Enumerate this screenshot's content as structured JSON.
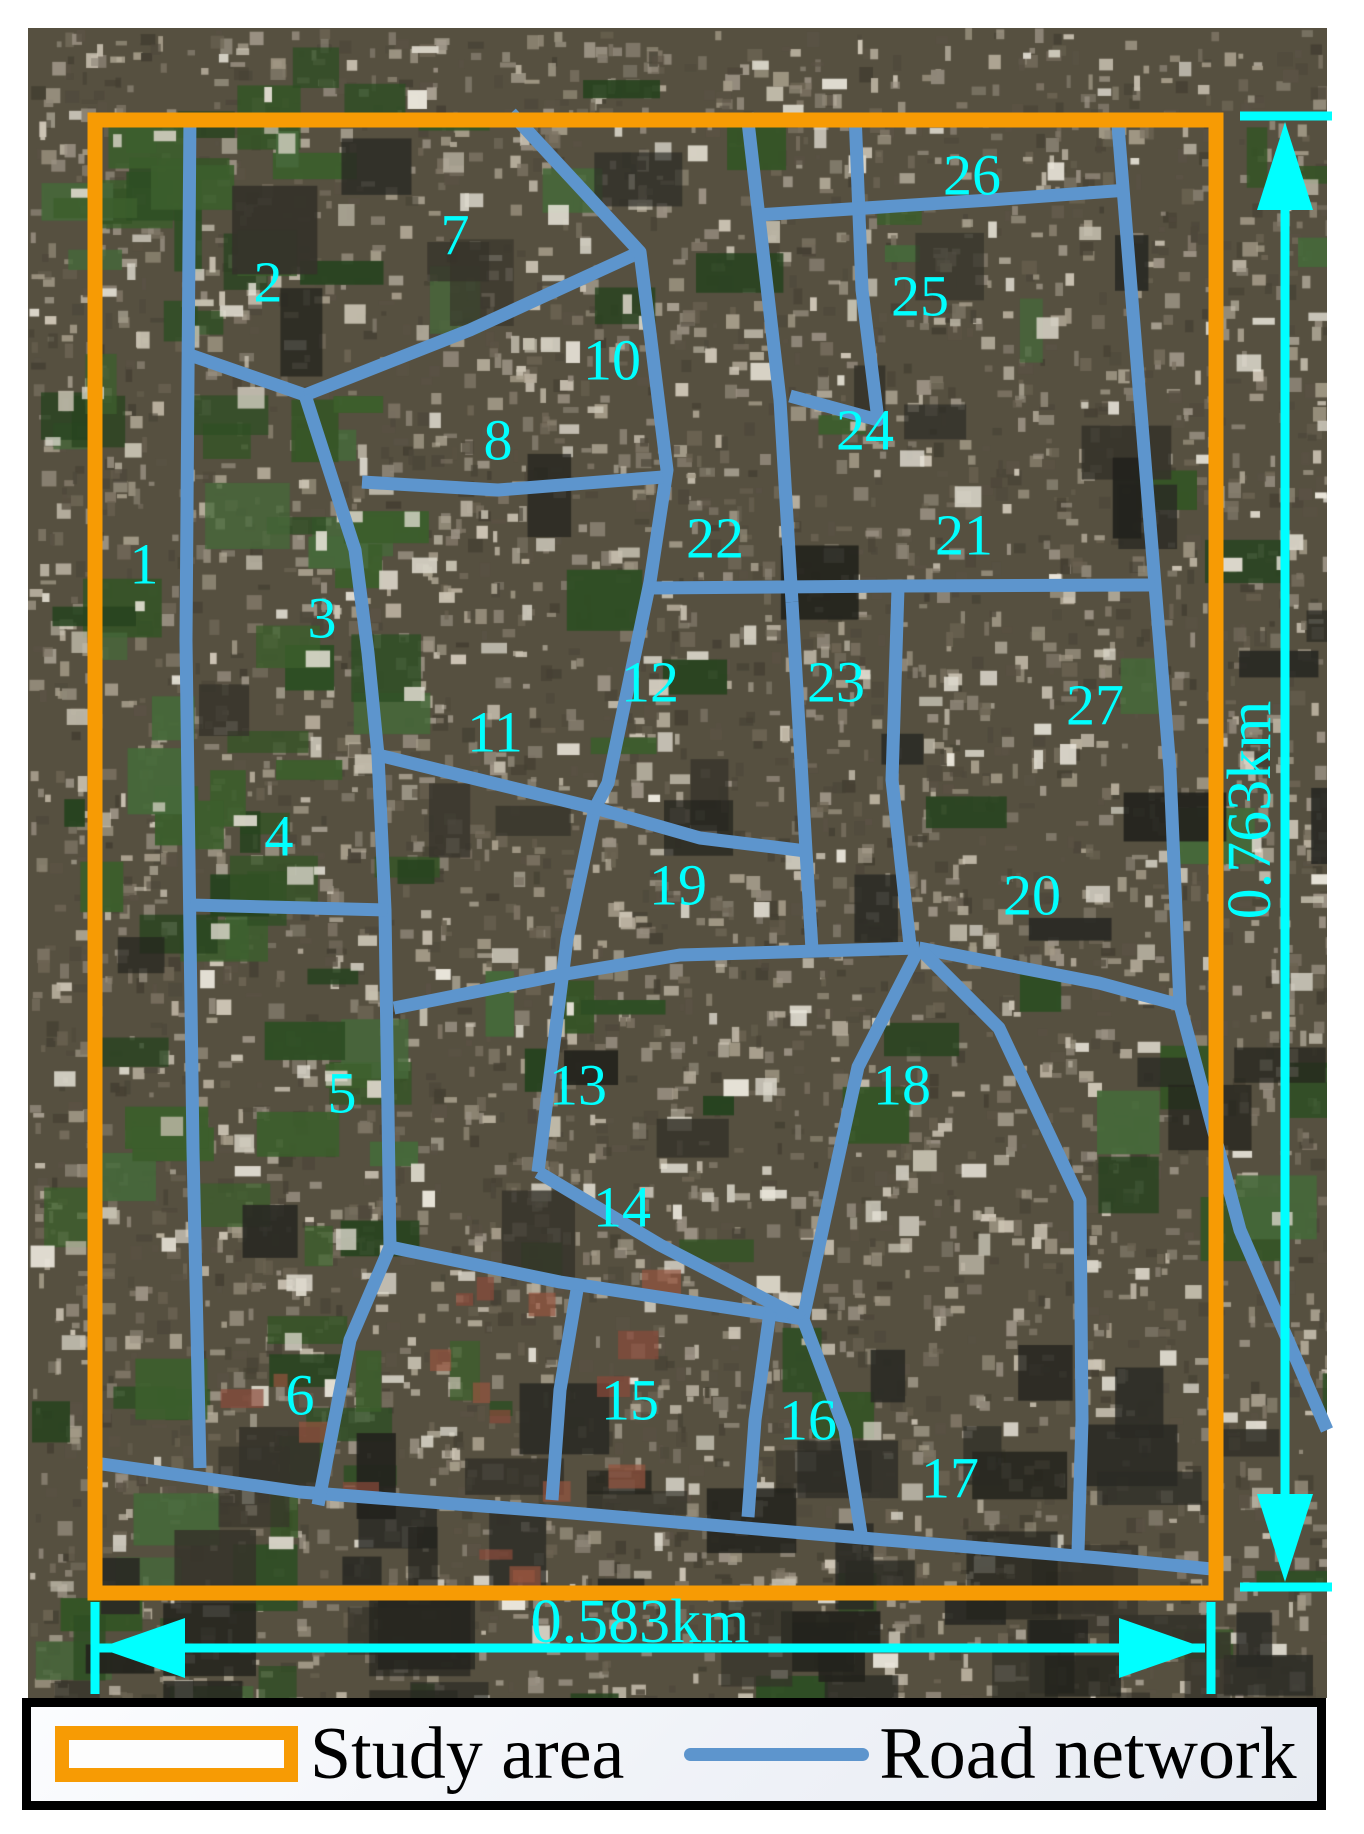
{
  "figure_type": "study-area-satellite-map",
  "colors": {
    "study_area": "#F79B04",
    "road": "#5D95CD",
    "annotation": "#00FFFF",
    "legend_text": "#000000",
    "legend_bg": "#f2f4f9"
  },
  "legend": {
    "items": [
      {
        "label": "Study area",
        "swatch": "orange-rect-icon"
      },
      {
        "label": "Road network",
        "swatch": "blue-line-icon"
      }
    ]
  },
  "dimensions": {
    "vertical": {
      "label": "0.763km",
      "label_pos": [
        1248,
        810
      ],
      "line": [
        1285,
        205,
        1285,
        1500
      ],
      "ticks": [
        [
          1240,
          116,
          1332,
          116
        ],
        [
          1240,
          1587,
          1332,
          1587
        ]
      ],
      "arrows": [
        [
          1285,
          122,
          1257,
          210,
          1313,
          210
        ],
        [
          1285,
          1582,
          1257,
          1494,
          1313,
          1494
        ]
      ]
    },
    "horizontal": {
      "label": "0.583km",
      "label_pos": [
        640,
        1624
      ],
      "line": [
        99,
        1648,
        1205,
        1648
      ],
      "ticks": [
        [
          95,
          1602,
          95,
          1694
        ],
        [
          1211,
          1602,
          1211,
          1694
        ]
      ],
      "arrows": [
        [
          99,
          1648,
          185,
          1618,
          185,
          1678
        ],
        [
          1205,
          1648,
          1119,
          1618,
          1119,
          1678
        ]
      ]
    }
  },
  "map": {
    "study_area_rect": {
      "x": 95,
      "y": 120,
      "width": 1121,
      "height": 1473,
      "stroke_width": 15
    },
    "road_stroke_width": 13,
    "regions": [
      {
        "n": "1",
        "x": 144,
        "y": 564
      },
      {
        "n": "2",
        "x": 268,
        "y": 282
      },
      {
        "n": "3",
        "x": 322,
        "y": 618
      },
      {
        "n": "4",
        "x": 279,
        "y": 836
      },
      {
        "n": "5",
        "x": 342,
        "y": 1093
      },
      {
        "n": "6",
        "x": 300,
        "y": 1395
      },
      {
        "n": "7",
        "x": 455,
        "y": 235
      },
      {
        "n": "8",
        "x": 498,
        "y": 440
      },
      {
        "n": "10",
        "x": 612,
        "y": 360
      },
      {
        "n": "11",
        "x": 495,
        "y": 732
      },
      {
        "n": "12",
        "x": 650,
        "y": 682
      },
      {
        "n": "13",
        "x": 578,
        "y": 1085
      },
      {
        "n": "14",
        "x": 622,
        "y": 1207
      },
      {
        "n": "15",
        "x": 630,
        "y": 1400
      },
      {
        "n": "16",
        "x": 808,
        "y": 1420
      },
      {
        "n": "17",
        "x": 950,
        "y": 1478
      },
      {
        "n": "18",
        "x": 902,
        "y": 1085
      },
      {
        "n": "19",
        "x": 678,
        "y": 885
      },
      {
        "n": "20",
        "x": 1032,
        "y": 895
      },
      {
        "n": "21",
        "x": 964,
        "y": 535
      },
      {
        "n": "22",
        "x": 715,
        "y": 538
      },
      {
        "n": "23",
        "x": 836,
        "y": 682
      },
      {
        "n": "24",
        "x": 865,
        "y": 430
      },
      {
        "n": "25",
        "x": 920,
        "y": 296
      },
      {
        "n": "26",
        "x": 972,
        "y": 175
      },
      {
        "n": "27",
        "x": 1095,
        "y": 705
      }
    ],
    "roads": [
      {
        "points": [
          [
            190,
            113
          ],
          [
            186,
            640
          ],
          [
            190,
            935
          ],
          [
            193,
            1150
          ],
          [
            200,
            1468
          ]
        ]
      },
      {
        "points": [
          [
            190,
            355
          ],
          [
            305,
            395
          ]
        ]
      },
      {
        "points": [
          [
            305,
            395
          ],
          [
            470,
            330
          ],
          [
            640,
            252
          ]
        ]
      },
      {
        "points": [
          [
            305,
            395
          ],
          [
            355,
            550
          ],
          [
            368,
            653
          ],
          [
            378,
            755
          ],
          [
            385,
            910
          ],
          [
            390,
            1247
          ]
        ]
      },
      {
        "points": [
          [
            511,
            113
          ],
          [
            640,
            252
          ],
          [
            667,
            470
          ],
          [
            650,
            582
          ],
          [
            608,
            783
          ],
          [
            595,
            808
          ],
          [
            567,
            939
          ],
          [
            538,
            1172
          ]
        ]
      },
      {
        "points": [
          [
            362,
            482
          ],
          [
            498,
            490
          ],
          [
            663,
            477
          ]
        ]
      },
      {
        "points": [
          [
            190,
            905
          ],
          [
            388,
            910
          ]
        ]
      },
      {
        "points": [
          [
            378,
            755
          ],
          [
            480,
            780
          ],
          [
            595,
            808
          ],
          [
            700,
            838
          ],
          [
            806,
            851
          ]
        ]
      },
      {
        "points": [
          [
            394,
            1008
          ],
          [
            560,
            975
          ],
          [
            680,
            955
          ],
          [
            919,
            948
          ]
        ]
      },
      {
        "points": [
          [
            919,
            948
          ],
          [
            1099,
            983
          ],
          [
            1180,
            1005
          ]
        ]
      },
      {
        "points": [
          [
            792,
            602
          ],
          [
            806,
            851
          ],
          [
            812,
            950
          ]
        ]
      },
      {
        "points": [
          [
            898,
            588
          ],
          [
            892,
            780
          ],
          [
            910,
            945
          ]
        ]
      },
      {
        "points": [
          [
            919,
            948
          ],
          [
            858,
            1067
          ],
          [
            803,
            1319
          ]
        ]
      },
      {
        "points": [
          [
            919,
            948
          ],
          [
            999,
            1028
          ],
          [
            1080,
            1200
          ],
          [
            1082,
            1420
          ],
          [
            1078,
            1552
          ]
        ]
      },
      {
        "points": [
          [
            390,
            1247
          ],
          [
            560,
            1282
          ],
          [
            803,
            1319
          ]
        ]
      },
      {
        "points": [
          [
            538,
            1172
          ],
          [
            660,
            1245
          ],
          [
            803,
            1319
          ]
        ]
      },
      {
        "points": [
          [
            577,
            1290
          ],
          [
            560,
            1390
          ],
          [
            552,
            1500
          ]
        ]
      },
      {
        "points": [
          [
            770,
            1312
          ],
          [
            755,
            1420
          ],
          [
            748,
            1517
          ]
        ]
      },
      {
        "points": [
          [
            803,
            1319
          ],
          [
            845,
            1430
          ],
          [
            862,
            1540
          ]
        ]
      },
      {
        "points": [
          [
            88,
            1462
          ],
          [
            300,
            1492
          ],
          [
            560,
            1512
          ],
          [
            850,
            1537
          ],
          [
            1100,
            1558
          ],
          [
            1222,
            1570
          ]
        ]
      },
      {
        "points": [
          [
            390,
            1247
          ],
          [
            350,
            1340
          ],
          [
            318,
            1505
          ]
        ]
      },
      {
        "points": [
          [
            747,
            113
          ],
          [
            780,
            400
          ],
          [
            792,
            602
          ]
        ]
      },
      {
        "points": [
          [
            855,
            113
          ],
          [
            862,
            290
          ],
          [
            878,
            420
          ],
          [
            790,
            396
          ]
        ]
      },
      {
        "points": [
          [
            757,
            215
          ],
          [
            990,
            200
          ],
          [
            1128,
            190
          ]
        ]
      },
      {
        "points": [
          [
            1117,
            113
          ],
          [
            1140,
            400
          ],
          [
            1155,
            585
          ],
          [
            1170,
            770
          ],
          [
            1180,
            1005
          ],
          [
            1240,
            1230
          ],
          [
            1327,
            1430
          ]
        ]
      },
      {
        "points": [
          [
            650,
            588
          ],
          [
            900,
            586
          ],
          [
            1155,
            585
          ]
        ]
      }
    ]
  }
}
